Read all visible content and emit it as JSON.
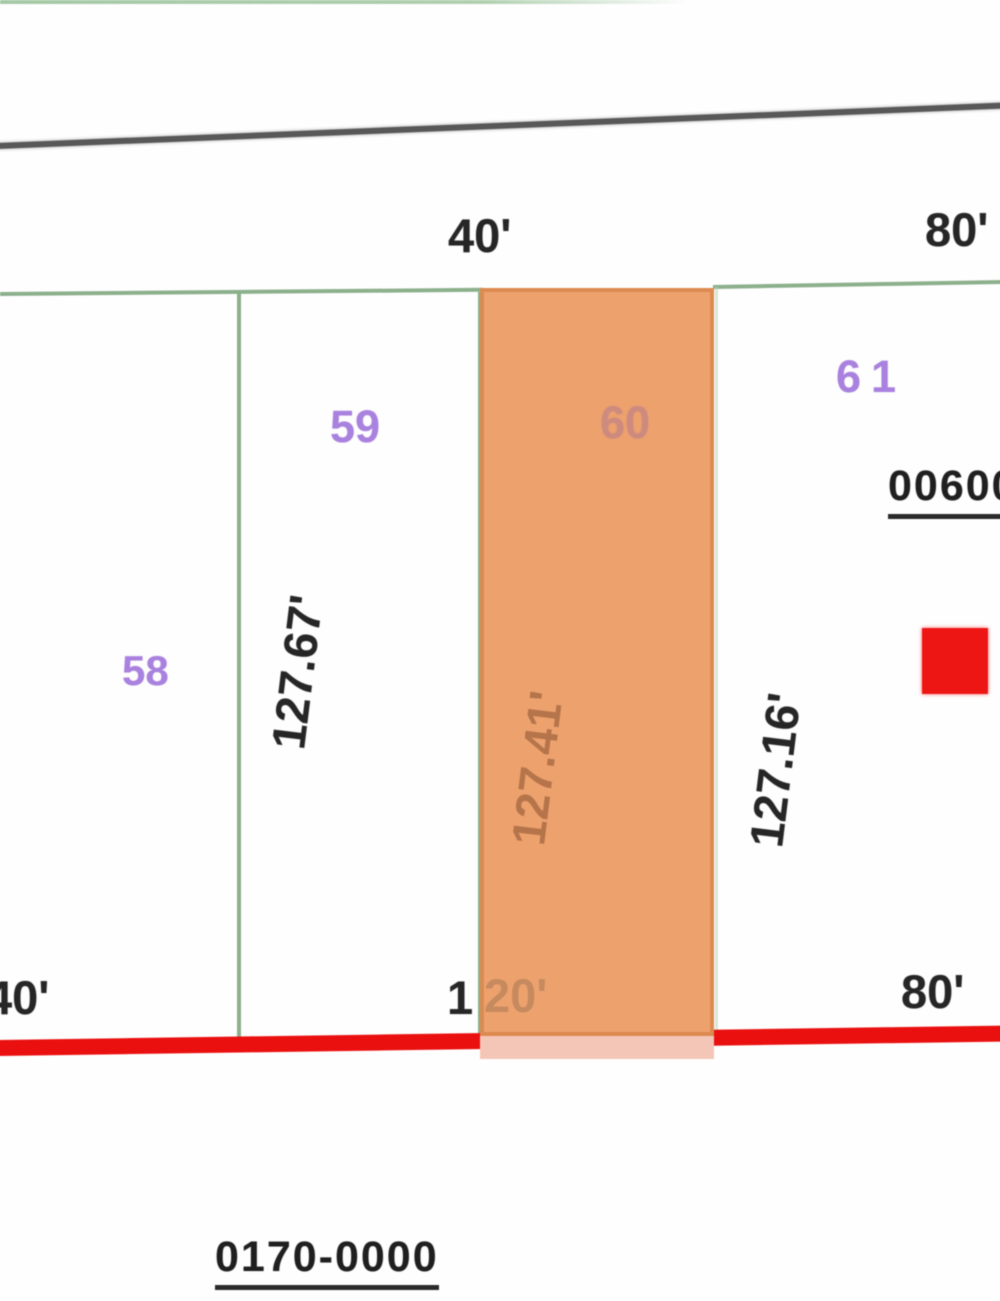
{
  "map": {
    "type": "parcel-plat-map",
    "lots": [
      {
        "number": "58",
        "frontage_dim": "",
        "highlighted": false
      },
      {
        "number": "59",
        "frontage_dim": "127.67'",
        "highlighted": false
      },
      {
        "number": "60",
        "frontage_dim": "127.41'",
        "highlighted": true
      },
      {
        "number": "61",
        "frontage_dim": "127.16'",
        "highlighted": false
      }
    ],
    "labels": {
      "top_width_40": "40'",
      "top_width_80": "80'",
      "lot58": "58",
      "lot59": "59",
      "lot60": "60",
      "lot61": "61",
      "dim59": "127.67'",
      "dim60": "127.41'",
      "dim61": "127.16'",
      "bottom_width_40": "40'",
      "bottom_width_120_prefix": "1",
      "bottom_width_120_suffix": "20'",
      "bottom_width_80": "80'",
      "parcel_id_right": "00600",
      "parcel_id_bottom": "0170-0000"
    },
    "colors": {
      "parcel_highlight_fill": "#eda26e",
      "parcel_highlight_border": "#da874c",
      "parcel_highlight_bottom_tint": "#f4c6b8",
      "boundary_green": "#8cb08c",
      "road_gray": "#585858",
      "street_red": "#ea1010",
      "lot_label_purple": "#a981de",
      "marker_red": "#ee1515",
      "dim_text_black": "#262626"
    }
  }
}
